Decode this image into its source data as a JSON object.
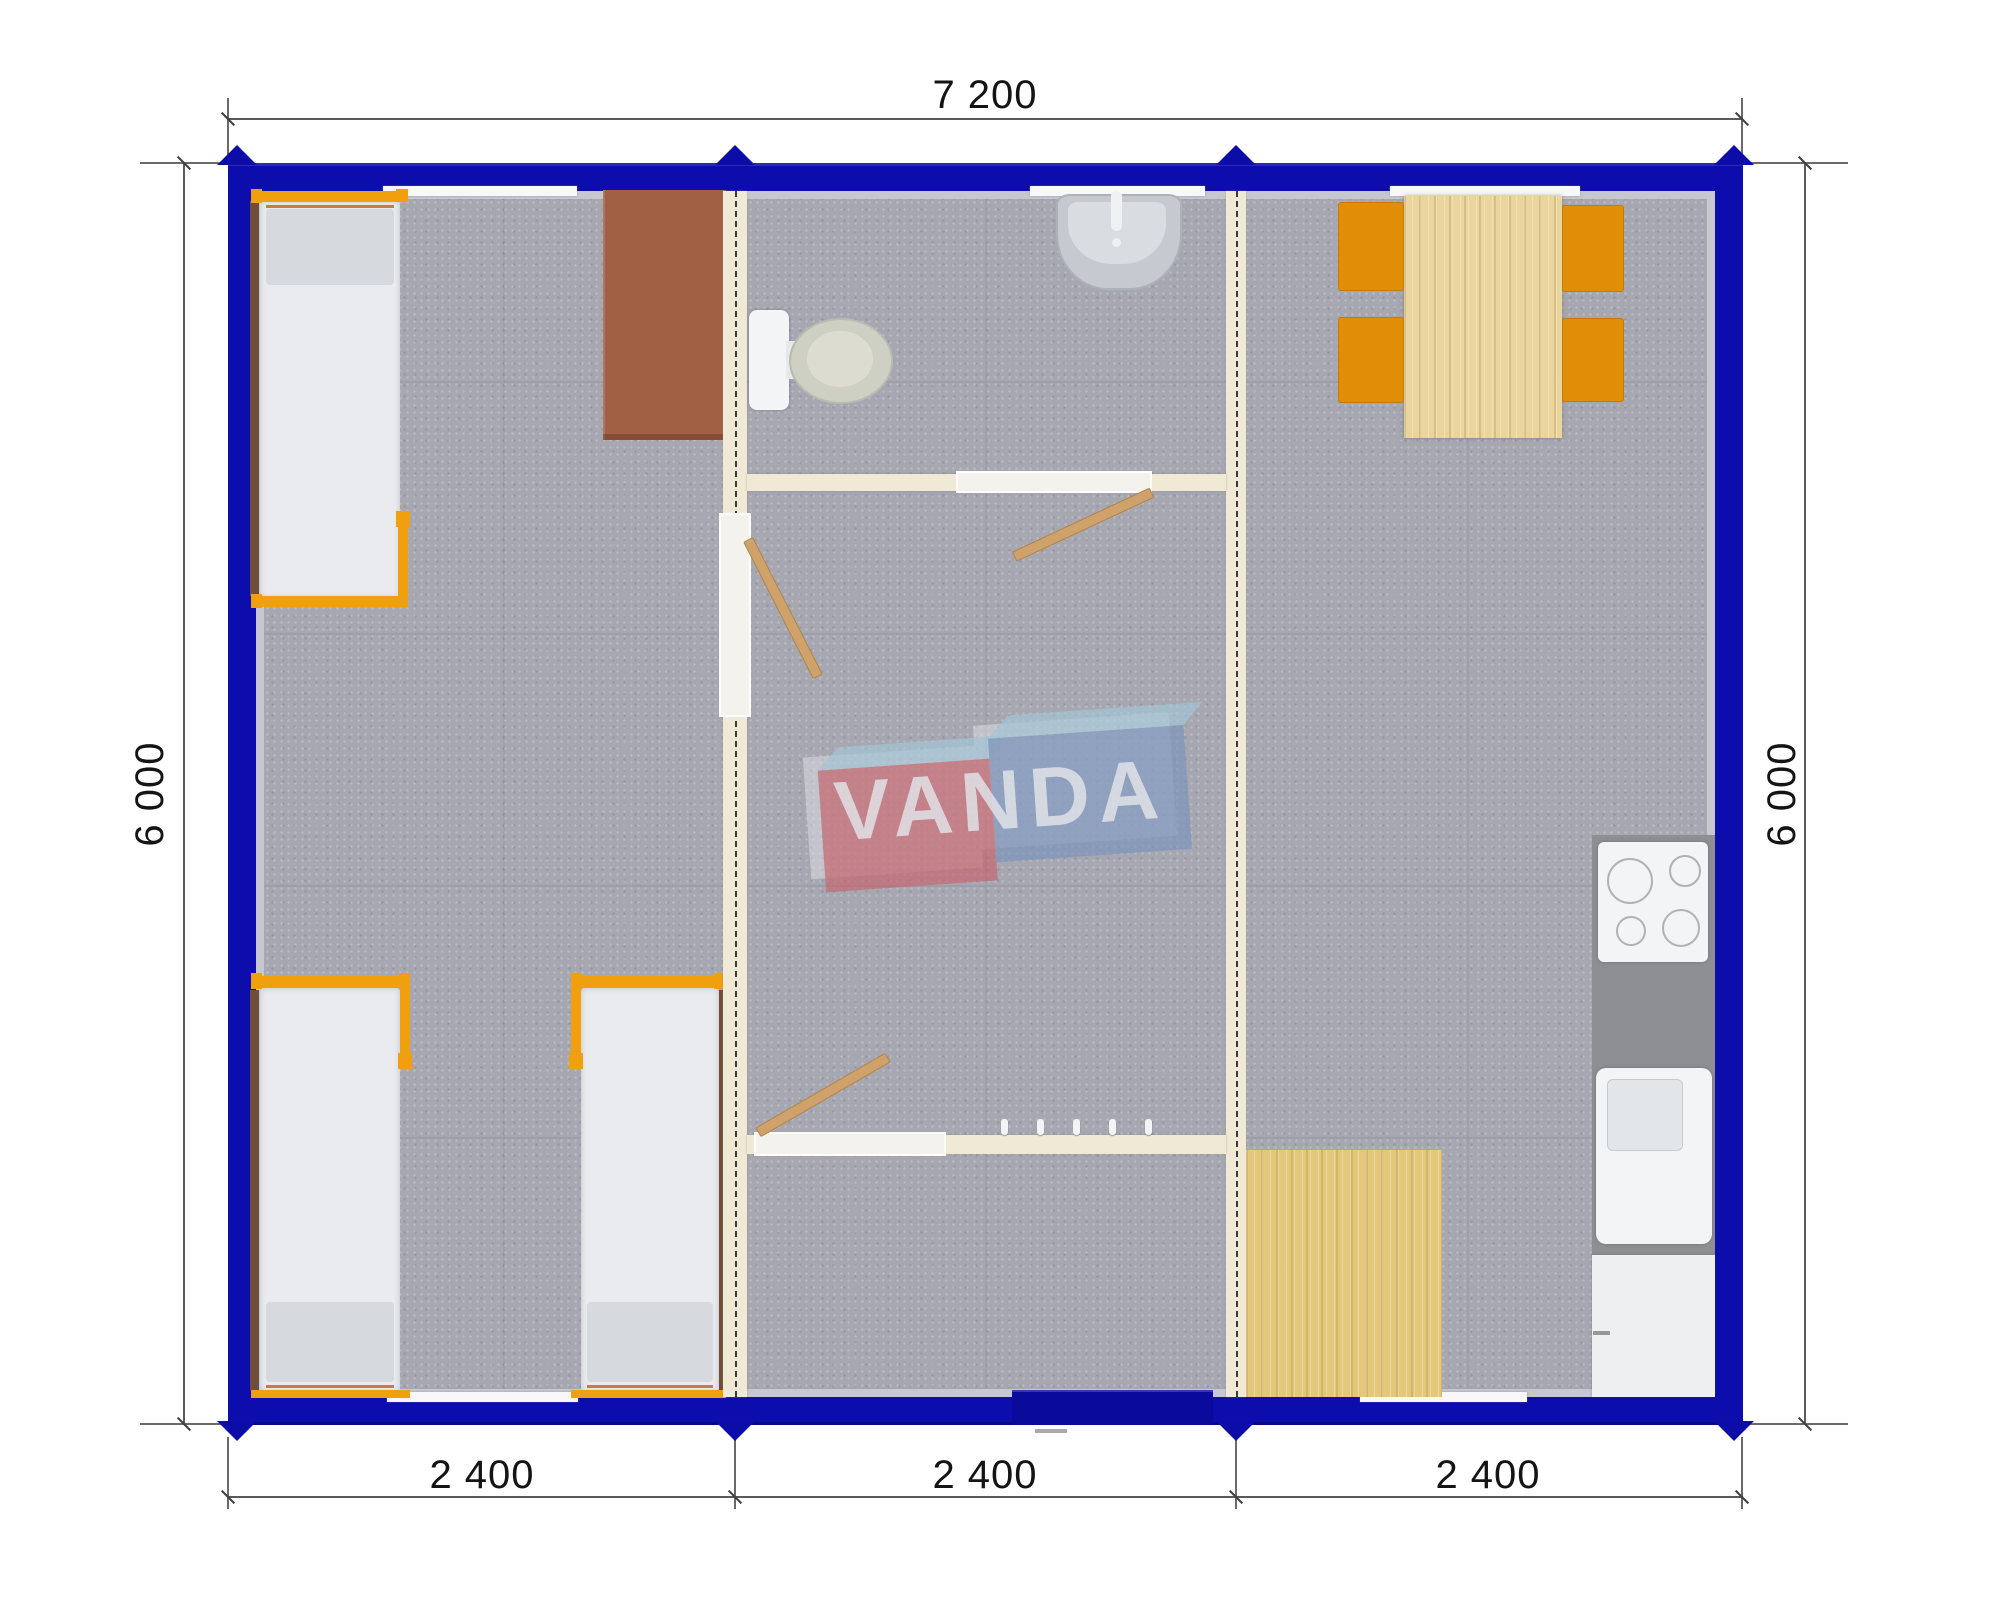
{
  "drawing": {
    "type": "modular-building floor plan, top view render",
    "brand": "VANDA",
    "brand_red_letters": "VAN",
    "brand_blue_letters": "DA",
    "dimensions": {
      "overall_width_mm": "7 200",
      "overall_depth_left_mm": "6 000",
      "overall_depth_right_mm": "6 000",
      "module_widths_mm": [
        "2 400",
        "2 400",
        "2 400"
      ]
    },
    "colors": {
      "frame_blue": "#0d0dad",
      "entrance_door_blue": "#0b0b9b",
      "interior_wall_cream": "#efe9d6",
      "carpet_gray": "#a6a7b1",
      "bed_frame_orange": "#f0a00e",
      "chair_orange": "#e08d08",
      "wood_light": "#ead59f",
      "desk_brown": "#a15f43",
      "counter_gray": "#8e8f93",
      "logo_red": "#c7636c",
      "logo_blue": "#7e95bd",
      "logo_top_blue": "#a2c7d9"
    }
  }
}
